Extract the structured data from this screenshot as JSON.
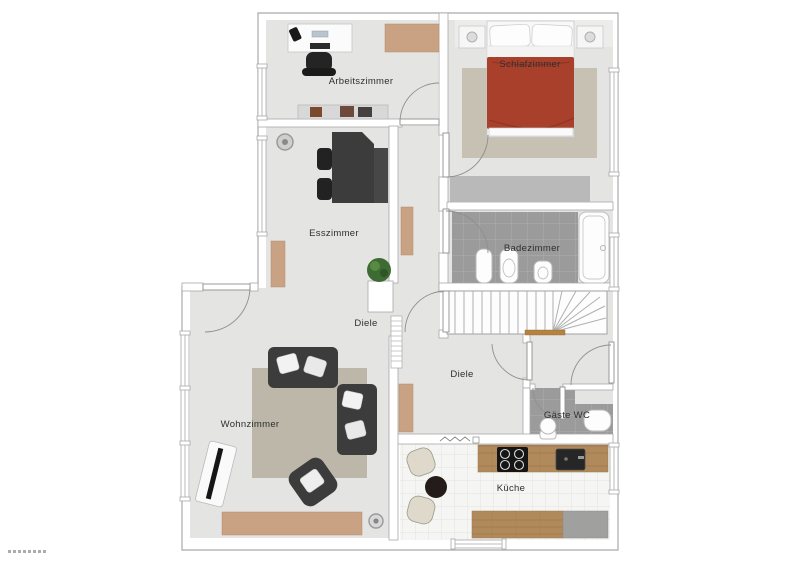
{
  "rooms": {
    "arbeitszimmer": "Arbeitszimmer",
    "schlafzimmer": "Schlafzimmer",
    "badezimmer": "Badezimmer",
    "esszimmer": "Esszimmer",
    "diele_upper": "Diele",
    "diele_lower": "Diele",
    "wohnzimmer": "Wohnzimmer",
    "gaeste_wc": "Gäste WC",
    "kueche": "Küche"
  },
  "colors": {
    "floor": "#e4e4e3",
    "wall-line": "#a9a9a9",
    "tile-dark": "#9b9b9b",
    "kitchen-floor": "#f5f5f3",
    "wood": "#b18a5c",
    "tan": "#c9a284",
    "rug-bedroom": "#c6c1b2",
    "rug-living": "#bcb7a9",
    "bed-red": "#a8402b",
    "dark-furniture": "#3c3c3c",
    "wardrobe-gray": "#b9b9b9",
    "label": "#2f2f2f"
  }
}
